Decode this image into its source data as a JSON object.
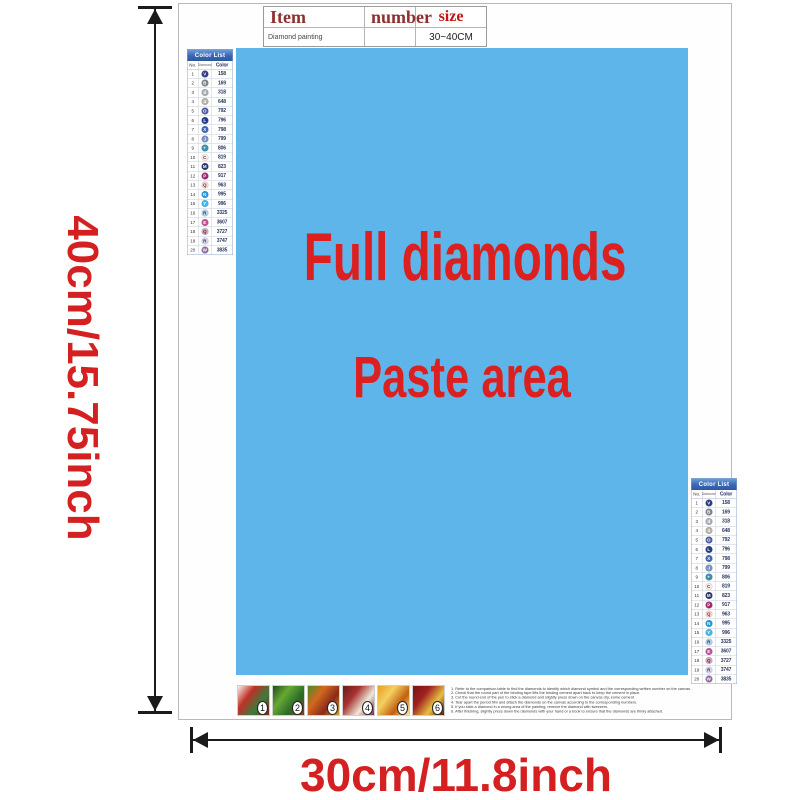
{
  "item_table": {
    "headers": [
      "Item",
      "number",
      "size"
    ],
    "row": {
      "item": "Diamond painting",
      "number": "",
      "size": "30~40CM"
    }
  },
  "paste_area": {
    "line1": "Full diamonds",
    "line2": "Paste area",
    "background_color": "#5eb5e9",
    "text_color": "#dc2020"
  },
  "dimensions": {
    "height_label": "40cm/15.75inch",
    "width_label": "30cm/11.8inch"
  },
  "color_list": {
    "title": "Color List",
    "columns": [
      "No.",
      "Diamond",
      "Color"
    ],
    "header_color": "#3c69b4",
    "rows": [
      {
        "no": "1",
        "symbol": "V",
        "code": "158",
        "hex": "#2c3a7c",
        "light": false
      },
      {
        "no": "2",
        "symbol": "B",
        "code": "169",
        "hex": "#7d828c",
        "light": false
      },
      {
        "no": "3",
        "symbol": "d",
        "code": "318",
        "hex": "#a9adb4",
        "light": false
      },
      {
        "no": "4",
        "symbol": "4",
        "code": "648",
        "hex": "#b9b4a8",
        "light": false
      },
      {
        "no": "5",
        "symbol": "O",
        "code": "792",
        "hex": "#4a5ba0",
        "light": false
      },
      {
        "no": "6",
        "symbol": "L",
        "code": "796",
        "hex": "#1f3b87",
        "light": false
      },
      {
        "no": "7",
        "symbol": "X",
        "code": "798",
        "hex": "#3c67ad",
        "light": false
      },
      {
        "no": "8",
        "symbol": "J",
        "code": "799",
        "hex": "#7490c8",
        "light": false
      },
      {
        "no": "9",
        "symbol": "+",
        "code": "806",
        "hex": "#3b93ab",
        "light": false
      },
      {
        "no": "10",
        "symbol": "C",
        "code": "819",
        "hex": "#ffeae6",
        "light": true
      },
      {
        "no": "11",
        "symbol": "M",
        "code": "823",
        "hex": "#23306b",
        "light": false
      },
      {
        "no": "12",
        "symbol": "P",
        "code": "917",
        "hex": "#a1256e",
        "light": false
      },
      {
        "no": "13",
        "symbol": "Q",
        "code": "963",
        "hex": "#ffd6d6",
        "light": true
      },
      {
        "no": "14",
        "symbol": "N",
        "code": "995",
        "hex": "#2496d6",
        "light": false
      },
      {
        "no": "15",
        "symbol": "Y",
        "code": "996",
        "hex": "#41b7ec",
        "light": false
      },
      {
        "no": "16",
        "symbol": "R",
        "code": "3325",
        "hex": "#b3d3ec",
        "light": true
      },
      {
        "no": "17",
        "symbol": "E",
        "code": "3607",
        "hex": "#c24f96",
        "light": false
      },
      {
        "no": "18",
        "symbol": "Q",
        "code": "3727",
        "hex": "#d9a8bc",
        "light": true
      },
      {
        "no": "19",
        "symbol": "R",
        "code": "3747",
        "hex": "#d5d9ef",
        "light": true
      },
      {
        "no": "20",
        "symbol": "W",
        "code": "3835",
        "hex": "#90689d",
        "light": false
      }
    ]
  },
  "footer": {
    "thumbnails": [
      {
        "label": "1",
        "colors": [
          "#f5f2ea",
          "#c03028",
          "#3a7d3a",
          "#8a1f1f"
        ]
      },
      {
        "label": "2",
        "colors": [
          "#1e4d1e",
          "#67a832",
          "#2a6b2a",
          "#8a3a1a"
        ]
      },
      {
        "label": "3",
        "colors": [
          "#4a8a2a",
          "#d2691e",
          "#8a2a1a",
          "#caa42a"
        ]
      },
      {
        "label": "4",
        "colors": [
          "#6b1a1a",
          "#a83232",
          "#f0e8d8",
          "#7a2a4a"
        ]
      },
      {
        "label": "5",
        "colors": [
          "#e8a020",
          "#f5d060",
          "#c06010",
          "#f8e8a0"
        ]
      },
      {
        "label": "6",
        "colors": [
          "#7a1515",
          "#a02020",
          "#e8c040",
          "#5a1010"
        ]
      }
    ],
    "instructions": [
      "1. Refer to the comparison table to find the diamonds to identify which diamond symbol and the corresponding written number on the canvas.",
      "2. Check that the round part of the binding tape lifts the binding cement apart back to keep the cement in place.",
      "3. Cut the round end of the pen to stick a diamond and slightly press down on the canvas dry, some cement.",
      "4. Tear apart the period film and attach the diamonds on the canvas according to the corresponding numbers.",
      "5. If you stick a diamond in a wrong area of the painting, remove the diamond with tweezers.",
      "6. After finishing, slightly press down the diamonds with your hand or a book to ensure that the diamonds are firmly attached."
    ]
  }
}
